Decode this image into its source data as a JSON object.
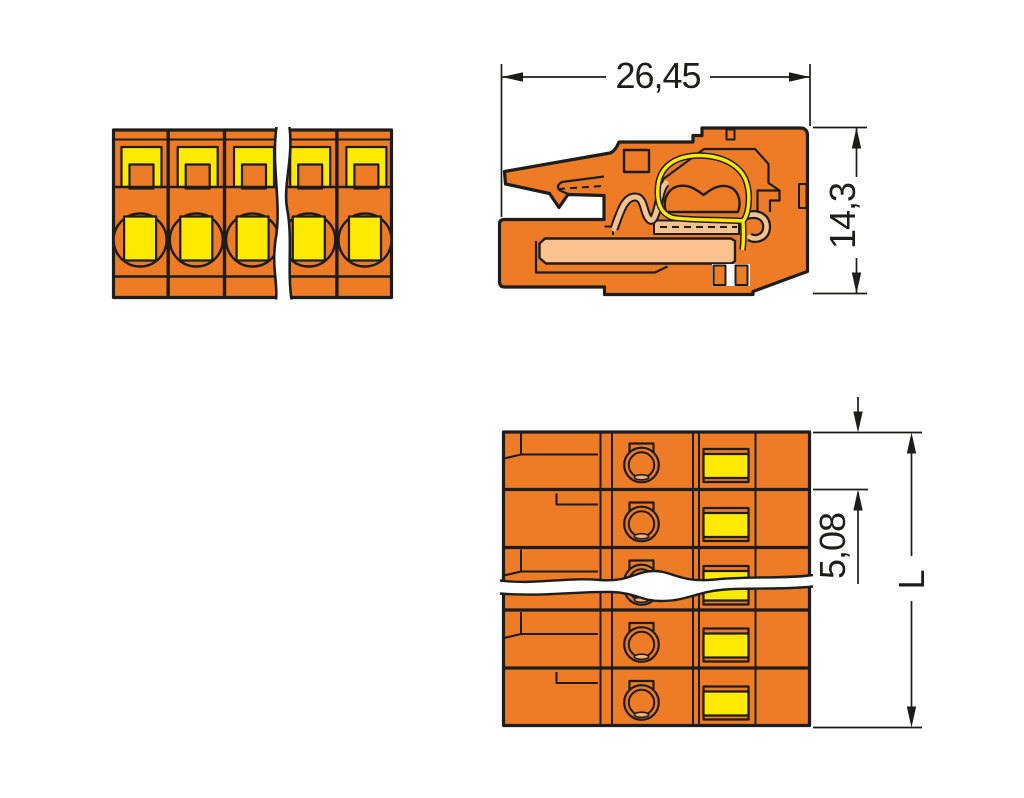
{
  "drawing": {
    "type": "technical-dimension-drawing",
    "views": {
      "front": {
        "label": "front-view",
        "poles_visible": 5,
        "has_break_line": true
      },
      "side": {
        "label": "side-cross-section-view"
      },
      "top": {
        "label": "top-view",
        "poles_visible": 5,
        "has_break_line": true
      }
    },
    "dimensions": {
      "total_width": "26,45",
      "total_height": "14,3",
      "pole_pitch": "5,08",
      "total_length": "L"
    },
    "colors": {
      "housing_orange": "#EE7C26",
      "detail_yellow": "#FFE900",
      "cavity_tan": "#F9C18D",
      "line_black": "#1D1D1B",
      "background": "#FFFFFF"
    }
  }
}
